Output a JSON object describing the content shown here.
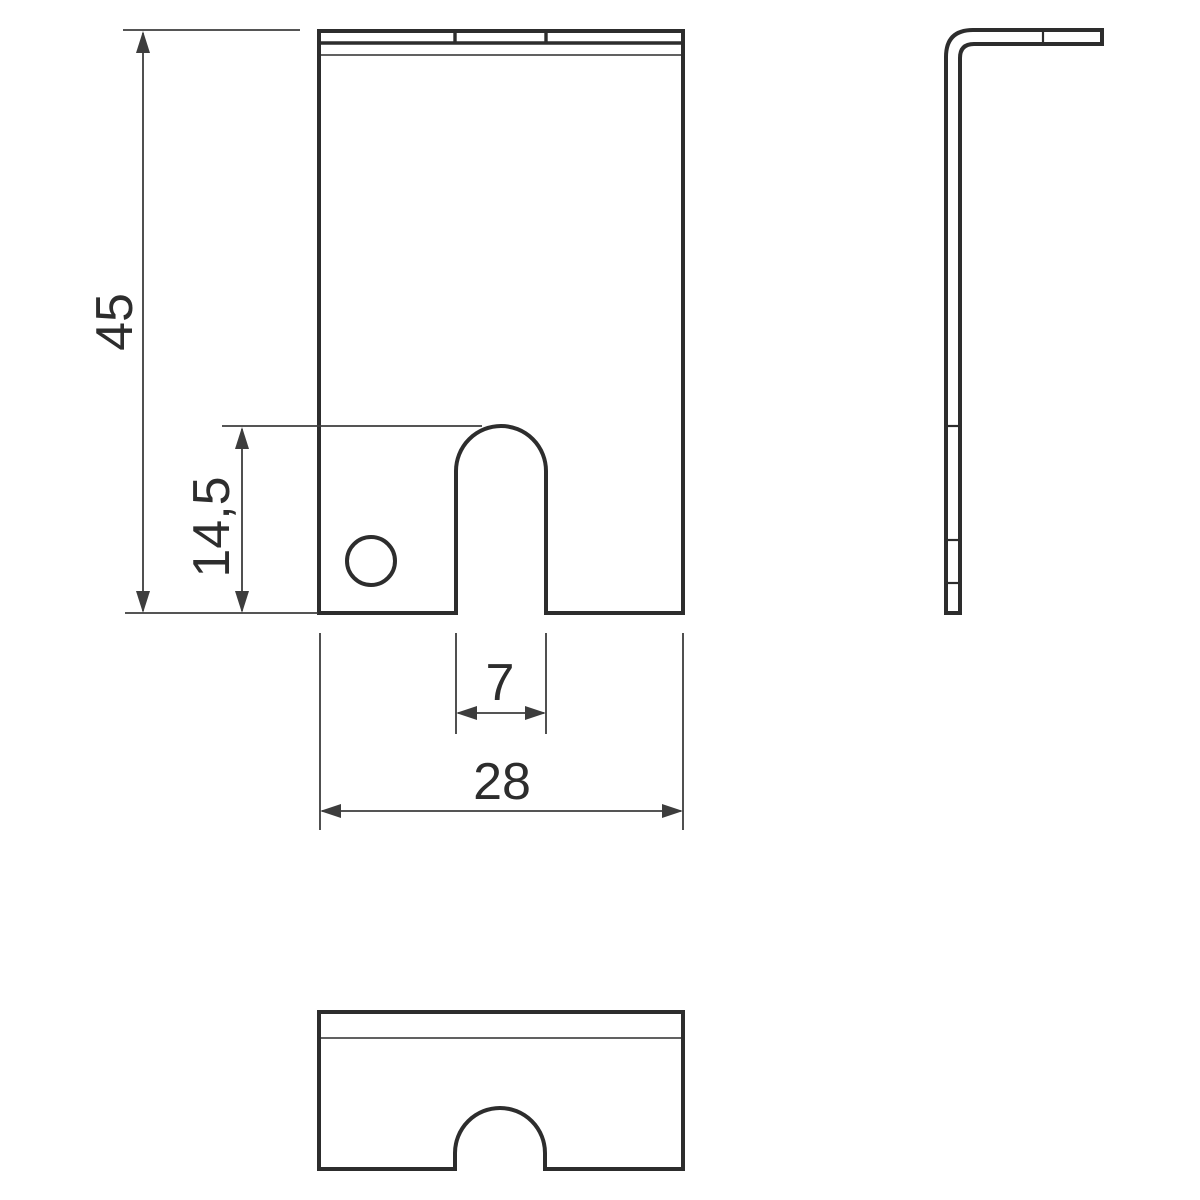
{
  "drawing": {
    "title": "sheet-metal L-bracket technical drawing",
    "views": {
      "front": "front view with U-slot and round hole",
      "side": "side view L-profile",
      "top": "top view with semicircular notch"
    },
    "colors": {
      "background": "#ffffff",
      "outline": "#2d2d2d",
      "dimension": "#3d3d3d"
    },
    "dimensions": {
      "overall_height": "45",
      "slot_depth": "14,5",
      "slot_width": "7",
      "overall_width": "28"
    }
  }
}
